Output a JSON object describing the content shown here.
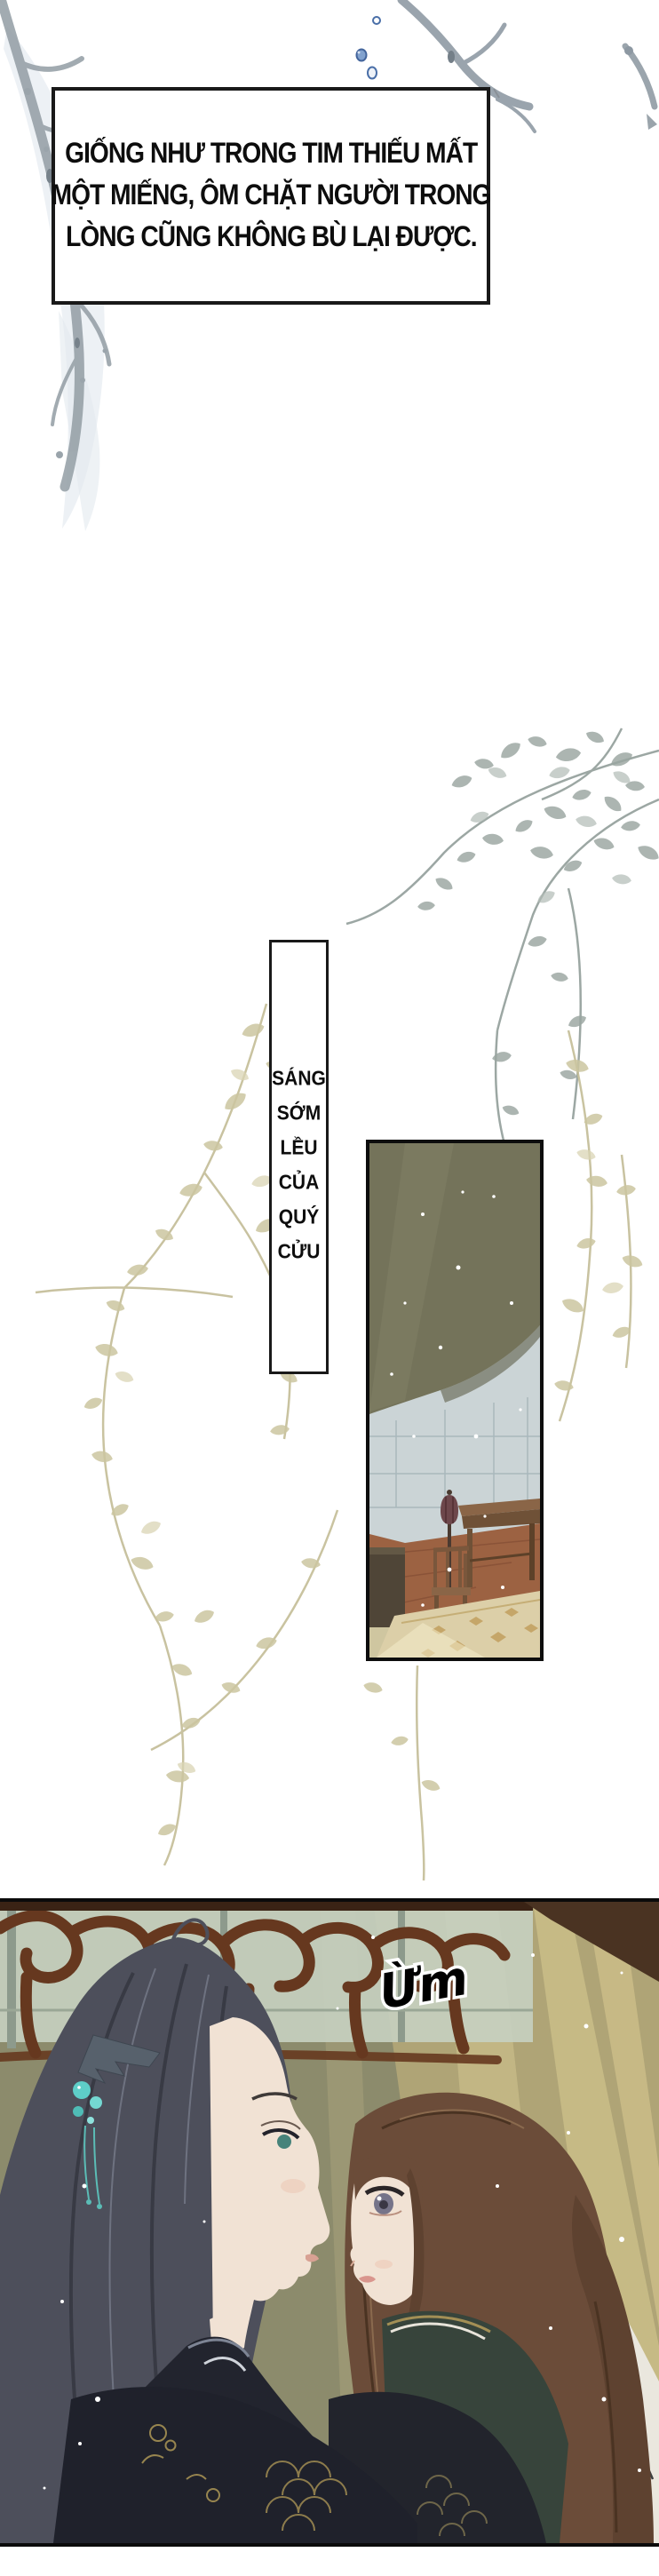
{
  "page": {
    "type": "comic-page",
    "language": "Vietnamese"
  },
  "captions": {
    "narration": {
      "lines": [
        "GIỐNG NHƯ TRONG TIM THIẾU MẤT",
        "MỘT MIẾNG, ÔM CHẶT NGƯỜI TRONG",
        "LÒNG CŨNG KHÔNG BÙ LẠI ĐƯỢC."
      ],
      "text": "GIỐNG NHƯ TRONG TIM THIẾU MẤT MỘT MIẾNG, ÔM CHẶT NGƯỜI TRONG LÒNG CŨNG KHÔNG BÙ LẠI ĐƯỢC."
    },
    "scene_label": {
      "words": [
        "SÁNG",
        "SỚM",
        "LỀU",
        "CỦA",
        "QUÝ",
        "CỬU"
      ],
      "text": "SÁNG SỚM LỀU CỦA QUÝ CỬU"
    },
    "sfx": {
      "text": "Ừm"
    }
  },
  "artwork": {
    "top_left": "gray ink branch",
    "top_right": "gray ink branch",
    "bubble_count": 3,
    "middle": "gray-blue and beige foliage",
    "interior_scene": "tent interior with canopy, lamp, chair, table, rug",
    "closeup_scene": "man with teal hairpin facing woman before carved lattice"
  },
  "colors": {
    "page_bg": "#ffffff",
    "ink_branch": "#96a0a7",
    "bubble_blue": "#4a6fa8",
    "caption_border": "#191919",
    "caption_text": "#0d0d0d",
    "foliage_gray": "#9aa6a1",
    "foliage_beige": "#ccc6a0",
    "canopy_olive": "#74735a",
    "wall_blue_gray": "#cbd4d6",
    "floor_rust": "#9c6242",
    "rug_beige": "#dccfa8",
    "scene_bg_olive": "#8c8b6c",
    "scene_gold": "#d6c791",
    "lattice_brown": "#66381f",
    "man_hair": "#4d4f5b",
    "hairpin_teal": "#5ecec8",
    "woman_hair": "#6b4c39",
    "skin": "#f1e2d4",
    "robe_dark": "#20222b",
    "robe_white": "#eae7de",
    "gold_pattern": "#97854f"
  }
}
